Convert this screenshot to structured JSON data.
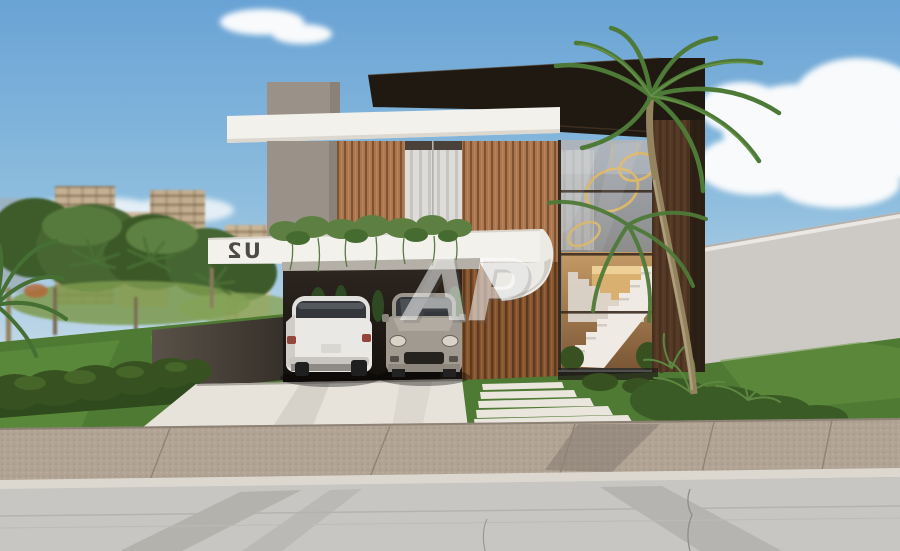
{
  "scene": {
    "title": "Modern two-story house exterior 3D rendering",
    "house_sign": {
      "text": "U2",
      "mirrored": true
    },
    "watermark": {
      "text": "AP"
    }
  },
  "colors": {
    "sky_top": "#69a3d5",
    "sky_mid": "#8fbede",
    "sky_horizon": "#c9dcea",
    "cloud": "#f8fafc",
    "roof": "#201911",
    "fascia": "#f3f1ec",
    "concrete": "#9a9289",
    "wood": "#ab764e",
    "wood_dark": "#7e5334",
    "wood_low": "#86542f",
    "wood_low_dark": "#5c3a1f",
    "frame": "#3a2b1f",
    "glass_top": "#a4abb3",
    "glass_bottom": "#756d64",
    "interior": "#c79c64",
    "stair": "#efeae3",
    "pendant": "#dcb76a",
    "ivy": "#5d8042",
    "grass": "#4f7a33",
    "grass_light": "#659340",
    "hedge": "#375220",
    "palm": "#4e7a38",
    "trunk": "#93835f",
    "building": "#c5b093",
    "building_blue": "#9fb0bd",
    "wall": "#cdcac6",
    "planter": "#4a4239",
    "driveway": "#e7e3db",
    "sidewalk": "#b1a494",
    "curb": "#dcd8d0",
    "road": "#c8c6c2",
    "car_white": "#eae8e4",
    "car_gray": "#a09a91",
    "car_glass": "#33373b",
    "taillight": "#93473c",
    "sign_text": "#4e4a44",
    "watermark_fill": "rgba(255,255,255,0.52)"
  }
}
